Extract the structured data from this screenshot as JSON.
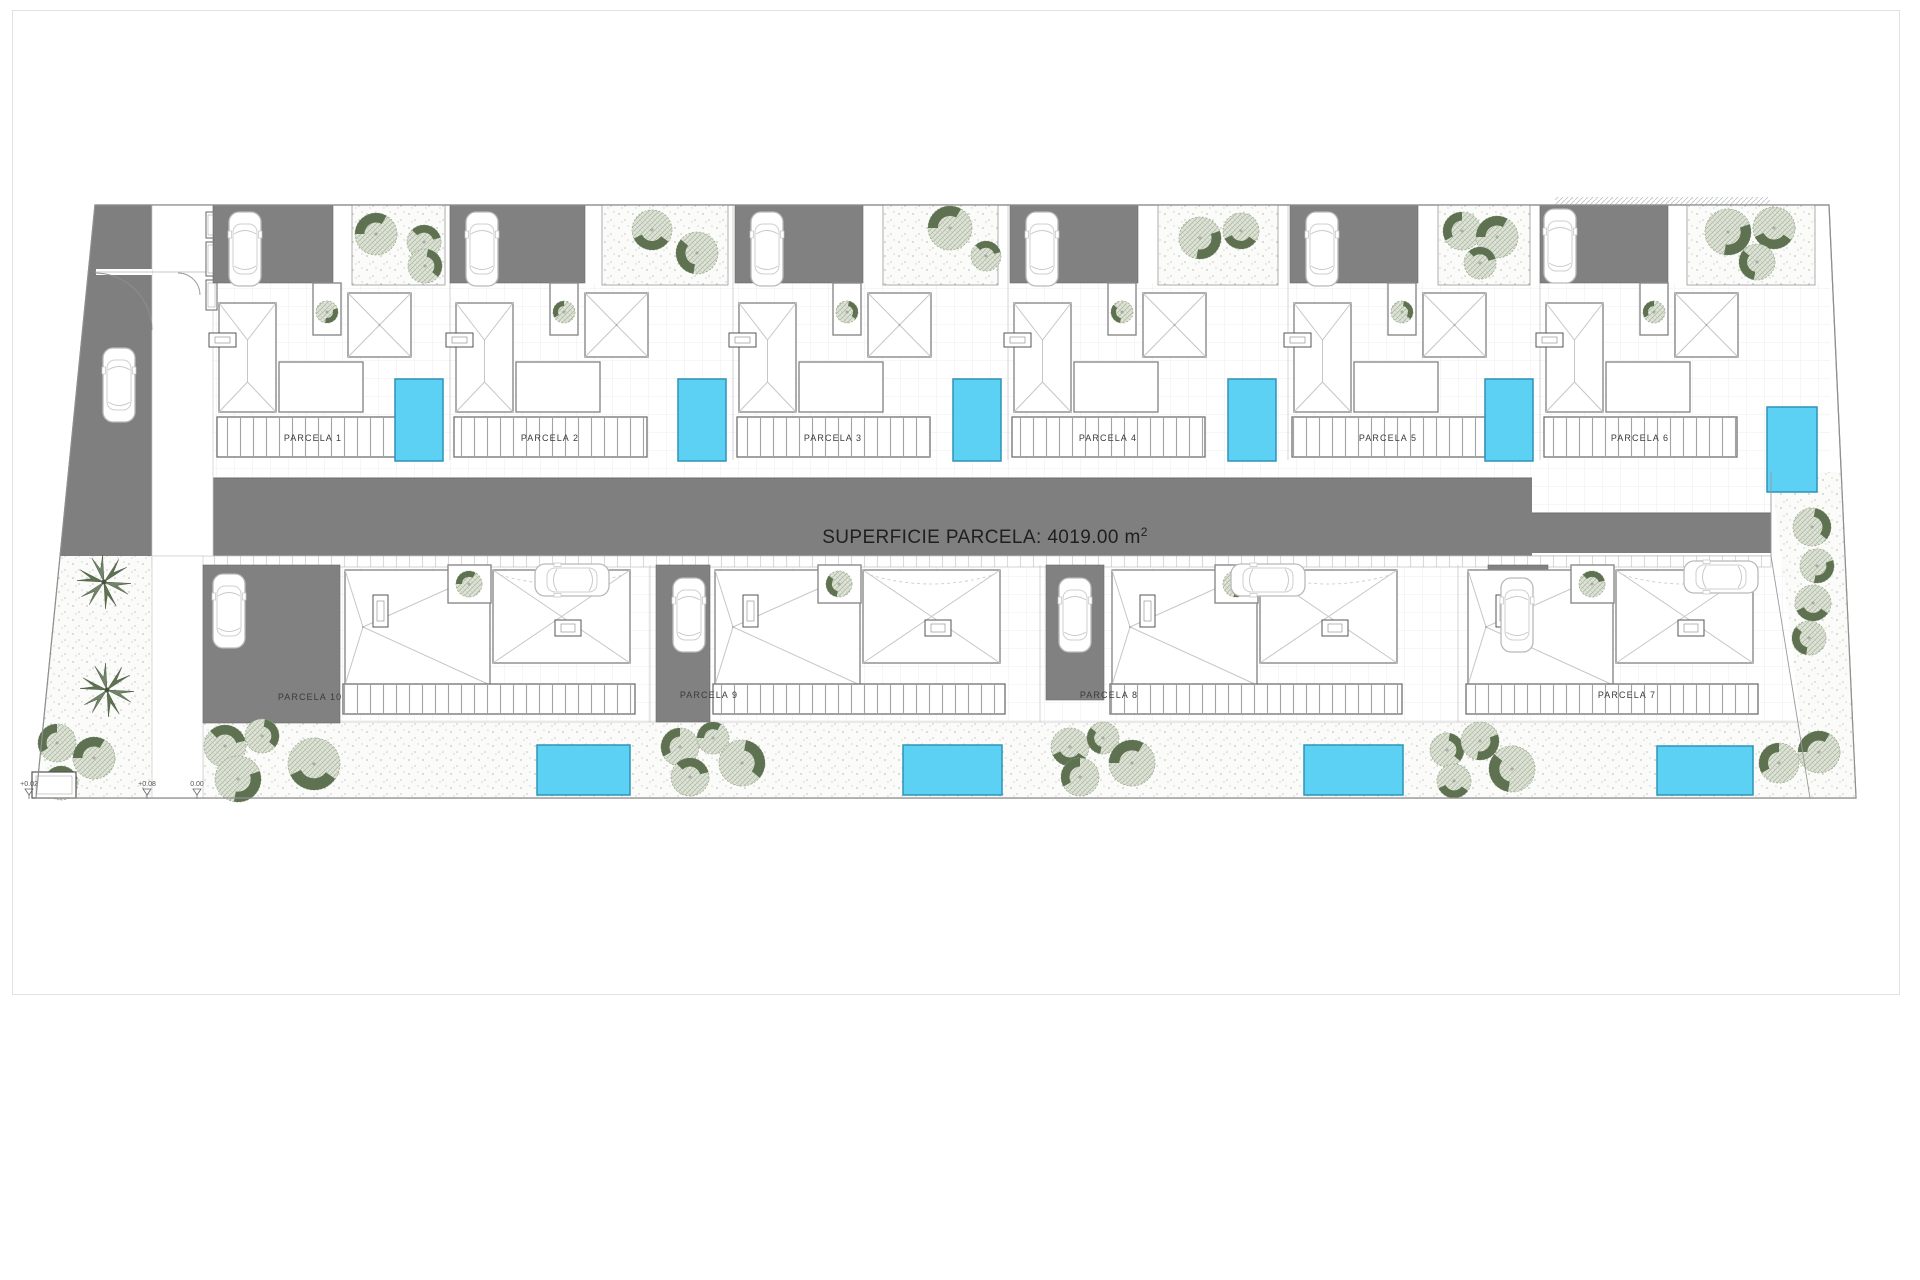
{
  "drawing": {
    "kind": "residential site plan",
    "road_area_label_prefix": "SUPERFICIE PARCELA: 4019.00 m",
    "road_area_label_sup": "2"
  },
  "parcels": {
    "top": [
      {
        "label": "PARCELA 1"
      },
      {
        "label": "PARCELA 2"
      },
      {
        "label": "PARCELA 3"
      },
      {
        "label": "PARCELA 4"
      },
      {
        "label": "PARCELA 5"
      },
      {
        "label": "PARCELA 6"
      }
    ],
    "bottom": [
      {
        "label": "PARCELA 10"
      },
      {
        "label": "PARCELA 9"
      },
      {
        "label": "PARCELA 8"
      },
      {
        "label": "PARCELA 7"
      }
    ]
  },
  "level_markers": [
    {
      "label": "+0.02"
    },
    {
      "label": "+0.08"
    },
    {
      "label": "0.00"
    }
  ],
  "colors": {
    "road": "#7f7f7f",
    "driveway": "#818181",
    "pool": "#5DD1F4",
    "pool_border": "#2F93B8",
    "tree_dark": "#5E7150",
    "tree_light": "#DDE3D6",
    "tree_hatch": "#A9B49D",
    "ground_dot": "#C2C6BD",
    "wall_line": "#8A8A8A",
    "roof_line": "#C6C6C6",
    "label_text": "#3a3a3a"
  },
  "icons": {
    "car": "car-icon",
    "tree": "tree-icon",
    "palm": "palm-icon",
    "pool": "pool-rect",
    "level_marker": "level-marker-icon"
  }
}
